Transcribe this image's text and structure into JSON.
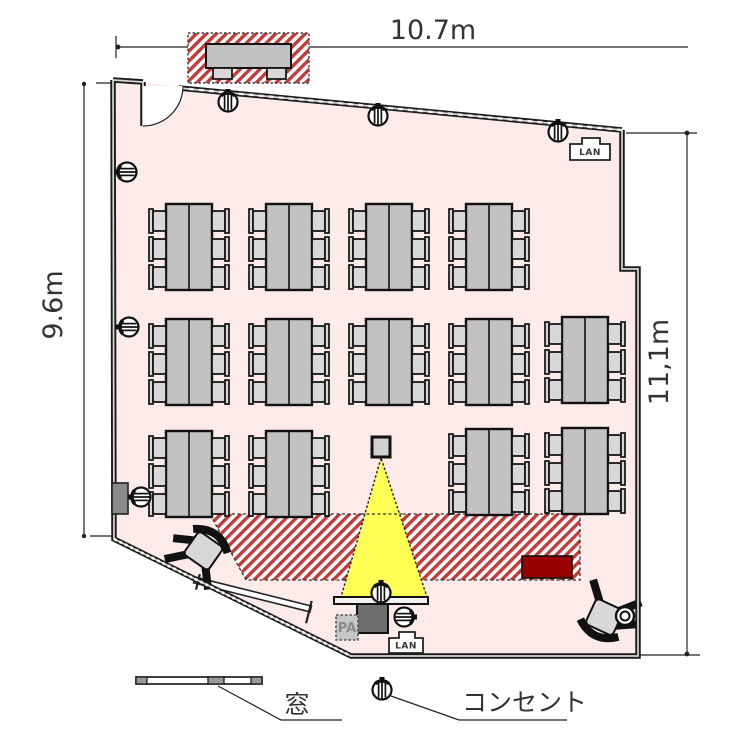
{
  "dimensions": {
    "top": "10.7m",
    "left": "9.6m",
    "right": "11,1m"
  },
  "legend": {
    "window_label": "窓",
    "outlet_label": "コンセント"
  },
  "labels": {
    "lan_top": "LAN",
    "lan_bottom": "LAN",
    "pa": "PA"
  },
  "colors": {
    "floor": "#fcebe9",
    "hatch_red": "#c13b3b",
    "podium_red": "#990000",
    "beam_yellow": "#ffff55",
    "table_gray": "#c2c2c2",
    "chair_gray": "#d8d8d8",
    "wall": "#1b1b1b",
    "equip_gray": "#6e6e6e"
  },
  "furniture": {
    "table_groups": [
      {
        "x": 149,
        "y": 203
      },
      {
        "x": 249,
        "y": 203
      },
      {
        "x": 349,
        "y": 203
      },
      {
        "x": 449,
        "y": 203
      },
      {
        "x": 149,
        "y": 318
      },
      {
        "x": 249,
        "y": 318
      },
      {
        "x": 349,
        "y": 318
      },
      {
        "x": 449,
        "y": 318
      },
      {
        "x": 545,
        "y": 316
      },
      {
        "x": 149,
        "y": 430
      },
      {
        "x": 249,
        "y": 430
      },
      {
        "x": 449,
        "y": 428
      },
      {
        "x": 545,
        "y": 427
      }
    ],
    "outlets": [
      {
        "x": 228,
        "y": 102,
        "rot": 0
      },
      {
        "x": 378,
        "y": 116,
        "rot": 0
      },
      {
        "x": 558,
        "y": 132,
        "rot": 0
      },
      {
        "x": 127,
        "y": 172,
        "rot": -90
      },
      {
        "x": 129,
        "y": 327,
        "rot": -90
      },
      {
        "x": 141,
        "y": 497,
        "rot": -90
      },
      {
        "x": 381,
        "y": 593,
        "rot": 0
      },
      {
        "x": 404,
        "y": 617,
        "rot": 90
      },
      {
        "x": 382,
        "y": 690,
        "rot": 0
      }
    ],
    "chairs": [
      {
        "x": 204,
        "y": 550,
        "rot": 35
      },
      {
        "x": 604,
        "y": 618,
        "rot": 205
      }
    ]
  }
}
